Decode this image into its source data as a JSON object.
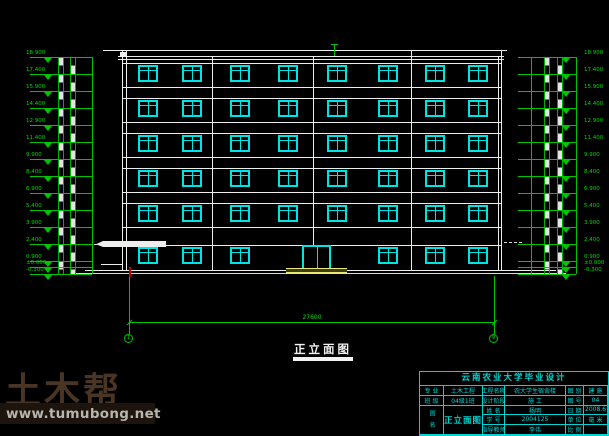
{
  "drawing": {
    "view_title": "正立面图",
    "overall_dim": "27600",
    "axis_left": "1",
    "axis_right": "9"
  },
  "elevation_marker_values": [
    "18.900",
    "17.400",
    "15.900",
    "14.400",
    "12.900",
    "11.400",
    "9.900",
    "8.400",
    "6.900",
    "5.400",
    "3.900",
    "2.400",
    "0.900",
    "±0.000",
    "-0.300"
  ],
  "watermark": {
    "logo": "土木帮",
    "url": "www.tumubong.net"
  },
  "titleblock": {
    "header": "云南农业大学毕业设计",
    "col1": [
      {
        "label": "专 业",
        "value": "土木工程"
      },
      {
        "label": "班 级",
        "value": "04级1班"
      },
      {
        "label": "姓 名",
        "value": "杨明"
      },
      {
        "label": "学 号",
        "value": "2004125"
      },
      {
        "label": "指导教师",
        "value": "李伟"
      }
    ],
    "mid": {
      "r1_label": "工程名称",
      "r1_value": "农大学生宿舍楼",
      "r2_label": "设计阶段",
      "r2_value": "施 工",
      "name_label": "图 名",
      "drawing_name": "正立面图"
    },
    "col3": [
      {
        "label": "图 别",
        "value": "建 施"
      },
      {
        "label": "图 号",
        "value": "04"
      },
      {
        "label": "日 期",
        "value": "2008.6"
      },
      {
        "label": "单 位",
        "value": "毫 米"
      },
      {
        "label": "比 例",
        "value": ""
      }
    ]
  },
  "colors": {
    "line_white": "#ededed",
    "dim_green": "#00c400",
    "window_cyan": "#00e4e4",
    "ground_yellow": "#e8e873",
    "titleblock_cyan": "#00d4d4",
    "watermark_brown": "#4a3424"
  }
}
